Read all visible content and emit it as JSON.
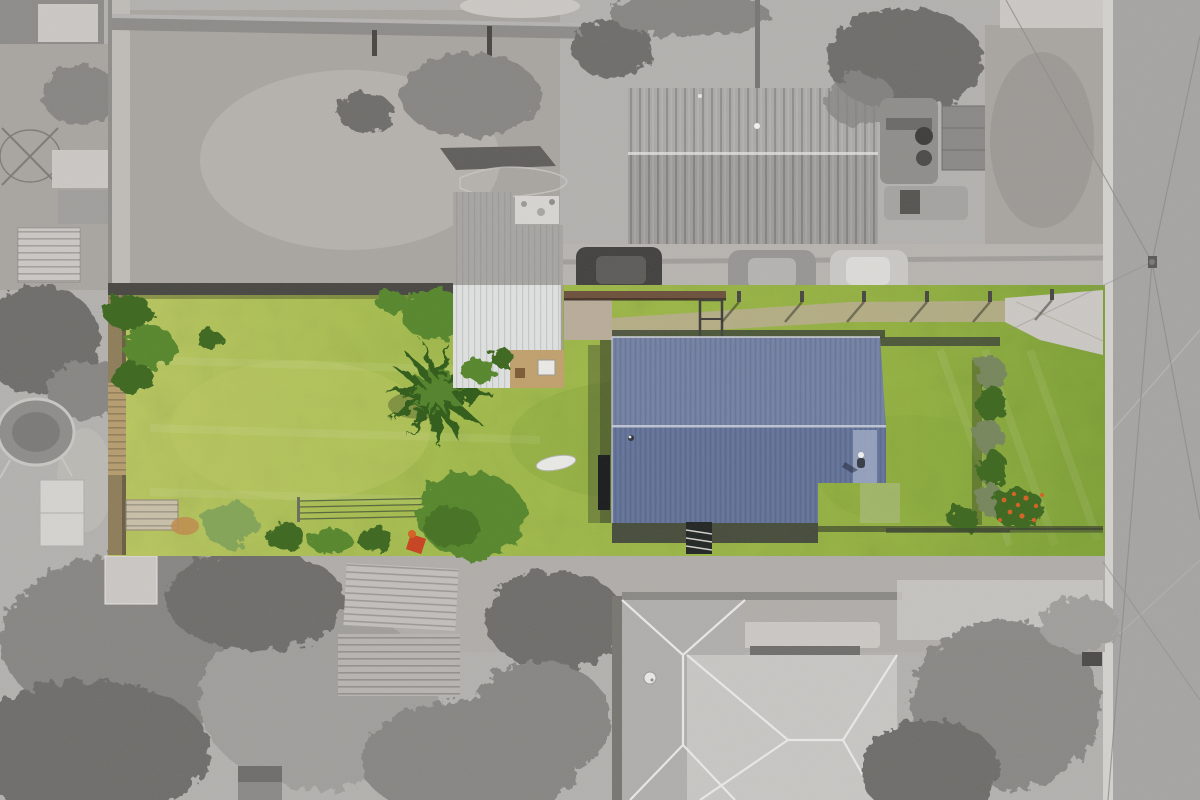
{
  "scene": {
    "type": "aerial-photo",
    "description": "Top-down drone photograph of a long residential lot shown in full colour (bright lawns, blue corrugated-iron roof house, white garden shed) while neighbouring properties, driveways and the street are desaturated to greyscale to highlight the property boundary.",
    "objects": [
      "subject lot highlighted in colour",
      "main house with blue corrugated roof",
      "person standing on roof edge",
      "white corrugated garden shed",
      "palm tree",
      "large garden trees",
      "clothesline wires",
      "boundary fences and hedges",
      "orange flowering shrub",
      "front concrete footpath with fence posts",
      "neighbouring house with grey corrugated roof (top)",
      "neighbouring hip-roof house (bottom)",
      "parked cars and utility truck",
      "street, kerb, power pole and wires",
      "trampoline and sheds in neighbouring yards",
      "letterbox"
    ]
  },
  "colors": {
    "canvas_gray": "#b3b1ae",
    "yard_gravel": "#a8a5a0",
    "yard_gravel_light": "#bfbcb7",
    "concrete_light": "#cbc8c4",
    "road_gray": "#a6a4a2",
    "kerb_light": "#d3d1cd",
    "wall_gray": "#8d8b88",
    "roof_top_house": "#9d9b98",
    "roof_top_house_light": "#aba9a6",
    "roof_bottom_house": "#c8c6c3",
    "roof_bottom_wing": "#b0aeab",
    "ridge_white": "#e9e8e6",
    "tree_gray_dark": "#6e6c69",
    "tree_gray": "#878582",
    "tree_gray_light": "#a09e9b",
    "shed_gray_corr": "#a7a5a2",
    "shed_dark_section": "#8e8c89",
    "rubble_light": "#d7d5d1",
    "fence_dark": "#474540",
    "fence_rust": "#6b4f3a",
    "car_dark": "#403f3d",
    "car_gray": "#979593",
    "car_silver": "#cac8c5",
    "truck_gray": "#8f8d8a",
    "lawn_yellow": "#bac85f",
    "lawn_green": "#a3bc4a",
    "lawn_front": "#93b23f",
    "lawn_deep": "#7fa335",
    "tree_green": "#55862a",
    "tree_green_dark": "#3a661d",
    "tree_green_pale": "#82a455",
    "hedge_muted": "#75855a",
    "palm_green": "#2e5a16",
    "roof_blue": "#5e6e95",
    "roof_blue_pale": "#99a4c0",
    "shed_white": "#dfe1e0",
    "deck_tan": "#c0a06c",
    "stone_path": "#b8ac98",
    "dirt_path": "#b9ab8f",
    "paving_dark": "#3c3f38",
    "fence_brown": "#8d7c58",
    "garden_tan": "#b59c6e",
    "flower_orange": "#d4601f",
    "red_item": "#c8401e",
    "wire_gray": "#8d8b88",
    "shadow_dark": "#2f2e2c",
    "pergola_pale": "#b8c29a"
  }
}
